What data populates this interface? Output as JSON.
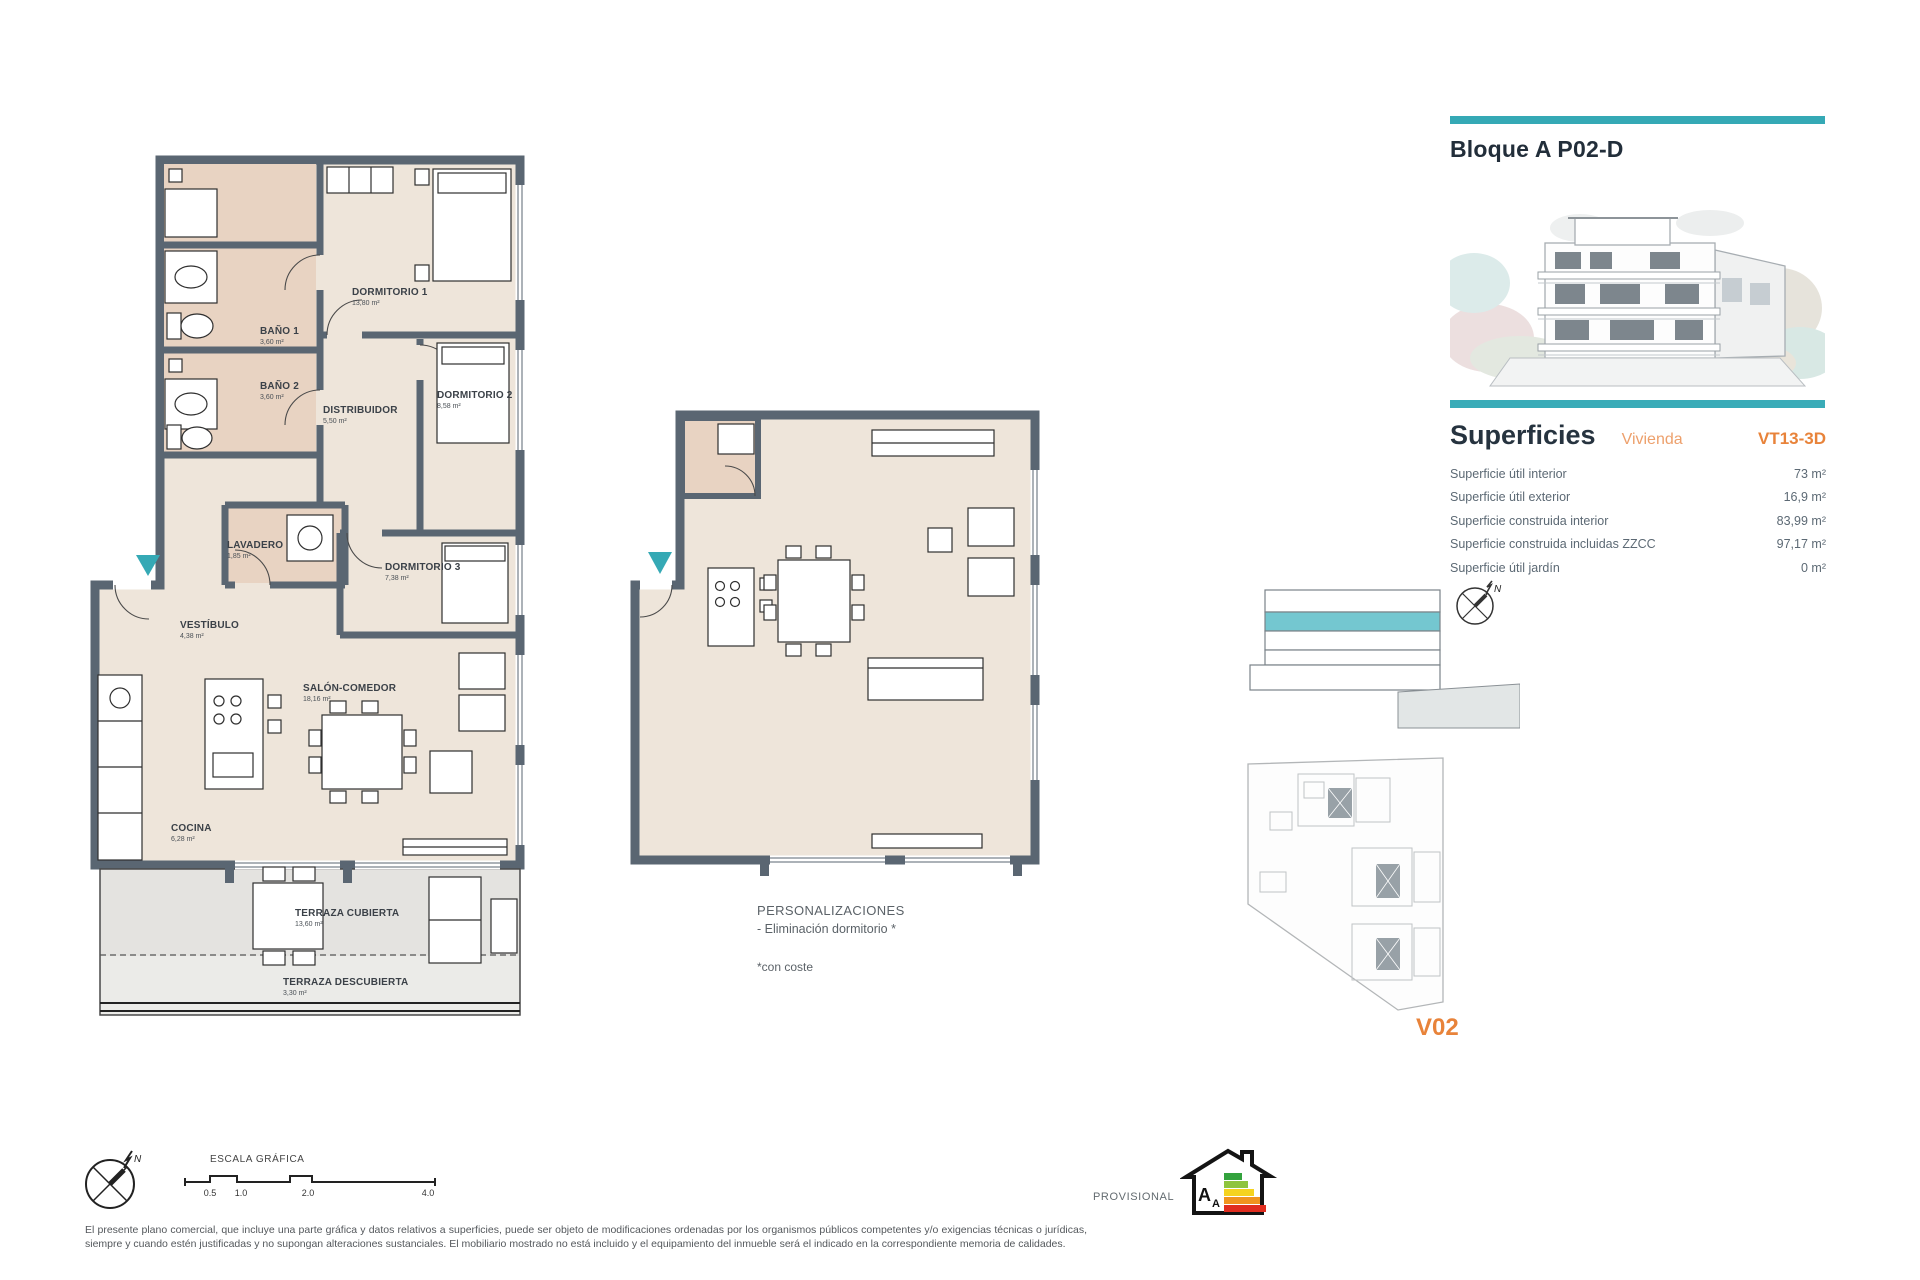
{
  "colors": {
    "teal": "#35a9b5",
    "orange": "#e8833a",
    "orange_light": "#eda06c",
    "navy": "#232f3b",
    "wall": "#5a6672",
    "floor": "#eee5da",
    "floor_warm": "#e8d3c2",
    "terrace": "#e4e3e0"
  },
  "panel": {
    "title": "Bloque A P02-D",
    "superficies": {
      "title": "Superficies",
      "subtitle": "Vivienda",
      "code": "VT13-3D",
      "rows": [
        {
          "label": "Superficie útil interior",
          "value": "73 m²"
        },
        {
          "label": "Superficie útil exterior",
          "value": "16,9 m²"
        },
        {
          "label": "Superficie construida interior",
          "value": "83,99 m²"
        },
        {
          "label": "Superficie construida incluidas ZZCC",
          "value": "97,17 m²"
        },
        {
          "label": "Superficie útil jardín",
          "value": "0 m²"
        }
      ]
    },
    "version": "V02"
  },
  "plan_main": {
    "rooms": {
      "dormitorio1": {
        "name": "DORMITORIO 1",
        "area": "13,80 m²"
      },
      "dormitorio2": {
        "name": "DORMITORIO 2",
        "area": "8,58 m²"
      },
      "dormitorio3": {
        "name": "DORMITORIO 3",
        "area": "7,38 m²"
      },
      "bano1": {
        "name": "BAÑO 1",
        "area": "3,60 m²"
      },
      "bano2": {
        "name": "BAÑO 2",
        "area": "3,60 m²"
      },
      "distribuidor": {
        "name": "DISTRIBUIDOR",
        "area": "5,50 m²"
      },
      "lavadero": {
        "name": "LAVADERO",
        "area": "1,85 m²"
      },
      "vestibulo": {
        "name": "VESTÍBULO",
        "area": "4,38 m²"
      },
      "salon": {
        "name": "SALÓN-COMEDOR",
        "area": "18,16 m²"
      },
      "cocina": {
        "name": "COCINA",
        "area": "6,28 m²"
      },
      "terraza_cubierta": {
        "name": "TERRAZA CUBIERTA",
        "area": "13,60 m²"
      },
      "terraza_descubierta": {
        "name": "TERRAZA DESCUBIERTA",
        "area": "3,30 m²"
      }
    }
  },
  "personalizaciones": {
    "title": "PERSONALIZACIONES",
    "item": "- Eliminación dormitorio *",
    "footnote": "*con coste"
  },
  "footer": {
    "scale_label": "ESCALA GRÁFICA",
    "scale_ticks": [
      "0.5",
      "1.0",
      "2.0",
      "4.0"
    ],
    "provisional": "PROVISIONAL",
    "disclaimer": "El presente plano comercial, que incluye una parte gráfica y datos relativos a superficies, puede ser objeto de modificaciones ordenadas por los organismos públicos competentes y/o exigencias técnicas o jurídicas, siempre y cuando estén justificadas y no supongan alteraciones sustanciales. El mobiliario mostrado no está incluido y el equipamiento del inmueble será el indicado en la correspondiente memoria de calidades."
  },
  "compass": {
    "north": "N"
  },
  "energy": {
    "letter": "A"
  }
}
